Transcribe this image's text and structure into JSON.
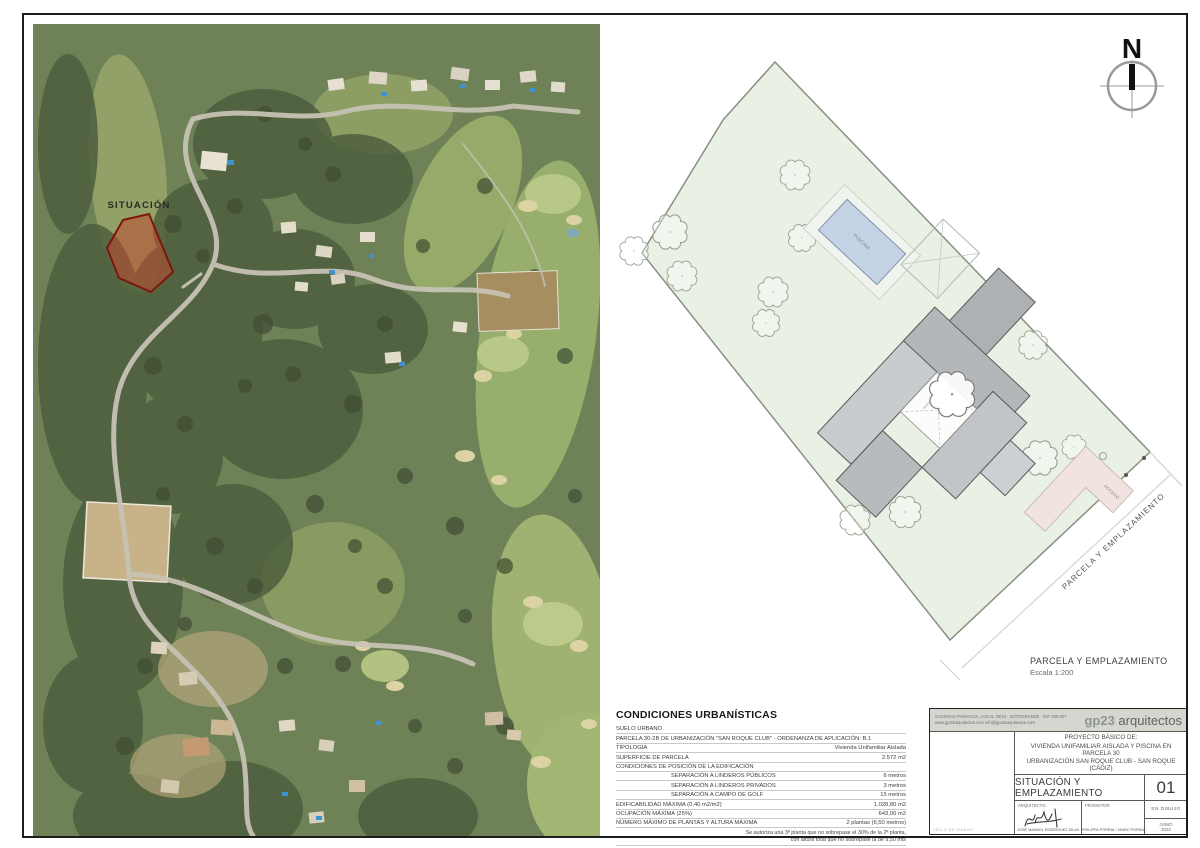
{
  "aerial": {
    "situacion_label": "SITUACIÓN",
    "parcel_fill": "#c04a32",
    "parcel_stroke": "#7e150c"
  },
  "site_plan": {
    "north_label": "N",
    "pool_label": "PISCINA",
    "patio_label": "PATIO",
    "access_label": "ACCESO",
    "boundary_label": "PARCELA Y EMPLAZAMIENTO",
    "caption_title": "PARCELA Y EMPLAZAMIENTO",
    "caption_scale": "Escala 1:200",
    "parcel_fill": "#e9f0e4"
  },
  "condiciones": {
    "title": "CONDICIONES URBANÍSTICAS",
    "rows": [
      {
        "label": "SUELO URBANO",
        "value": ""
      },
      {
        "label": "PARCELA 30-2B DE URBANIZACIÓN \"SAN ROQUE CLUB\"  -  ORDENANZA DE APLICACIÓN: B.1",
        "value": ""
      },
      {
        "label": "TIPOLOGÍA",
        "value": "Vivienda Unifamiliar Aislada"
      },
      {
        "label": "SUPERFICIE DE PARCELA",
        "value": "2.572 m2"
      },
      {
        "label": "CONDICIONES DE POSICIÓN DE LA EDIFICACIÓN",
        "value": ""
      },
      {
        "label": "SEPARACIÓN A LINDEROS PÚBLICOS",
        "value": "6 metros"
      },
      {
        "label": "SEPARACIÓN A LINDEROS PRIVADOS",
        "value": "3 metros"
      },
      {
        "label": "SEPARACIÓN A CAMPO DE GOLF",
        "value": "15 metros"
      },
      {
        "label": "EDIFICABILIDAD MÁXIMA (0,40 m2/m2)",
        "value": "1.028,80 m2"
      },
      {
        "label": "OCUPACIÓN MÁXIMA (25%)",
        "value": "643,00 m2"
      },
      {
        "label": "NÚMERO MÁXIMO DE PLANTAS Y ALTURA MÁXIMA",
        "value": "2 plantas (6,50 metros)"
      }
    ],
    "note_line1": "Se autoriza una 3ª planta que no sobrepase el 30% de la 2ª planta,",
    "note_line2": "con altura total que no sobrepase la de 9,50 mts"
  },
  "title_block": {
    "contact_line1": "GALERÍAS PANIAGUA, LOCAL 25/24  -  SOTOGRANDE  -  607 409 607",
    "contact_line2": "www.gp23arquitectos.com      info@gp23arquitectos.com",
    "brand_gp23": "gp23",
    "brand_arquitectos": " arquitectos",
    "project_line1": "PROYECTO BÁSICO DE:",
    "project_line2": "VIVIENDA UNIFAMILIAR AISLADA Y PISCINA EN PARCELA 30",
    "project_line3": "URBANIZACIÓN SAN ROQUE CLUB - SAN ROQUE (CÁDIZ)",
    "sheet_title": "SITUACIÓN Y EMPLAZAMIENTO",
    "sheet_number": "01",
    "architect_label": "ARQUITECTO:",
    "architect_name": "JOSÉ MANUEL RODRÍGUEZ SILVA",
    "promoter_label": "PROMOTOR:",
    "promoter_name": "PHILIPPA PORRAL / MARC PORRAL",
    "status": "EN DIBUJO",
    "date_line1": "JUNIO",
    "date_line2": "2022",
    "sello": "SELLO DE VISADO"
  }
}
